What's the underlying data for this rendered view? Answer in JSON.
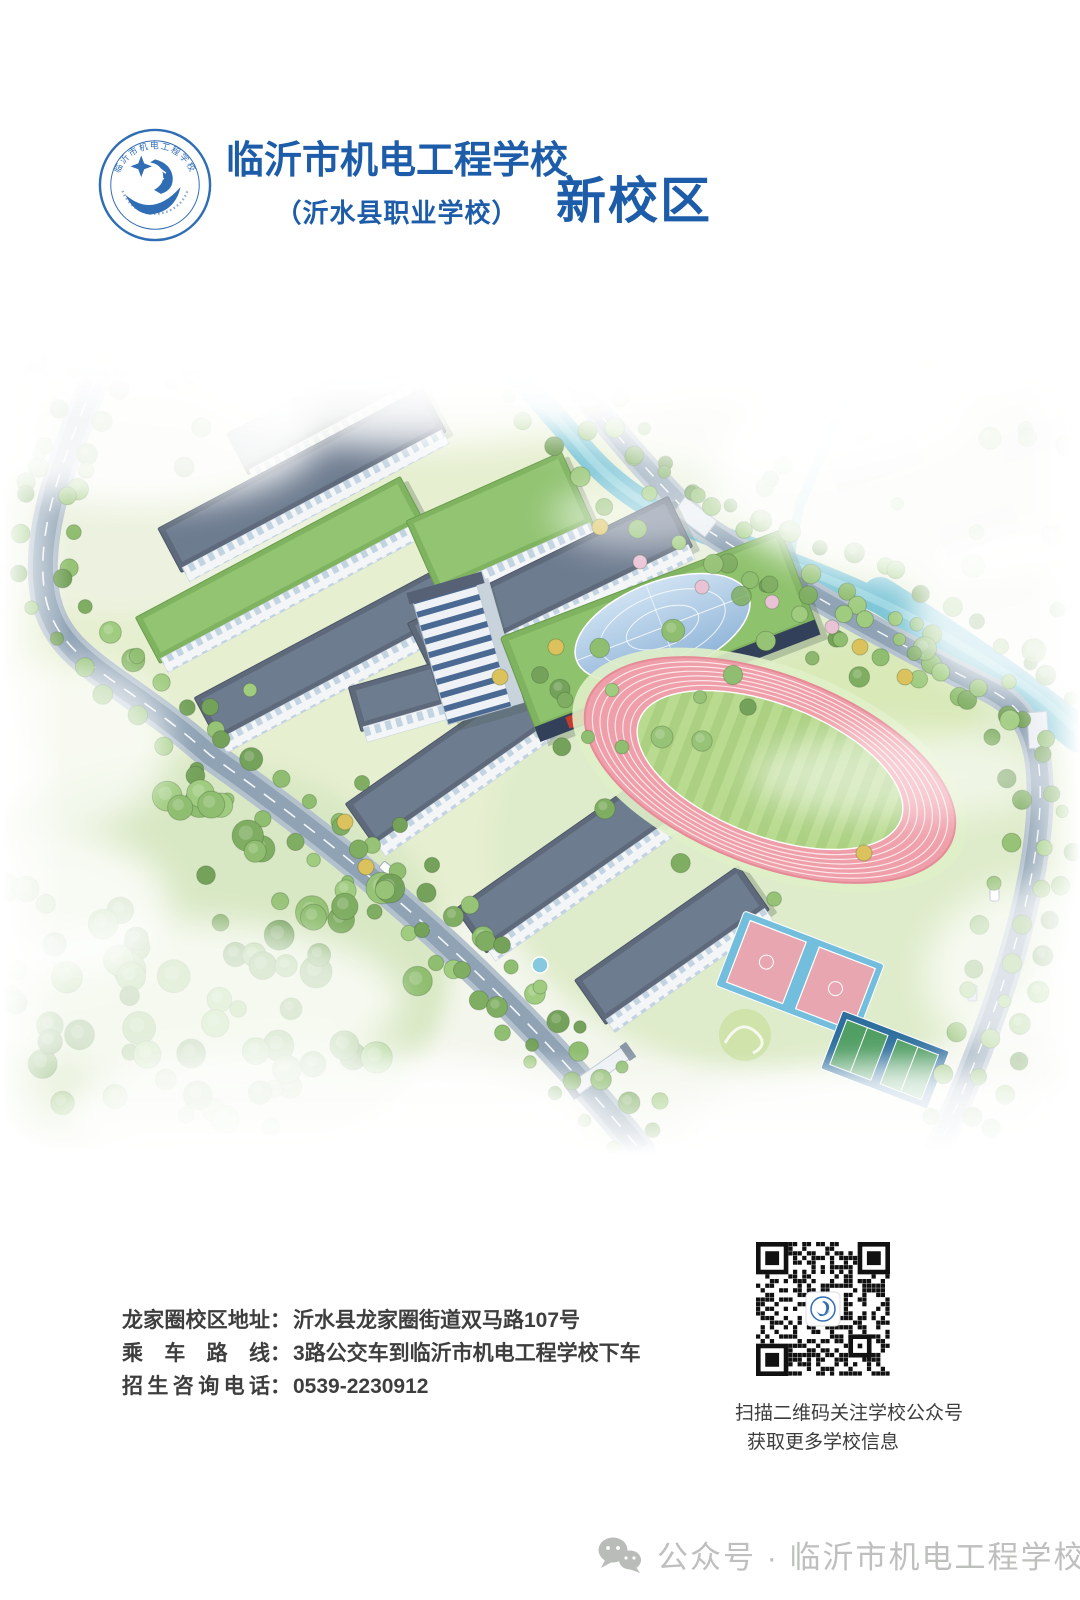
{
  "header": {
    "school_name": "临沂市机电工程学校",
    "school_subtitle": "（沂水县职业学校）",
    "campus_label": "新校区",
    "brand_color": "#1d5ca8",
    "logo": {
      "icon": "school-emblem",
      "ring_text": "临沂市机电工程学校"
    }
  },
  "campus_art": {
    "icon": "campus-aerial-view"
  },
  "contact": {
    "separator": "：",
    "lines": [
      {
        "label": "龙家圈校区地址",
        "value": "沂水县龙家圈街道双马路107号"
      },
      {
        "label": "乘车路线",
        "value": "3路公交车到临沂市机电工程学校下车"
      },
      {
        "label": "招生咨询电话",
        "value": "0539-2230912"
      }
    ]
  },
  "qr_section": {
    "icon": "qr-code",
    "caption_line1": "扫描二维码关注学校公众号",
    "caption_line2": "获取更多学校信息"
  },
  "footer": {
    "wechat_icon": "wechat-chat-bubbles",
    "watermark_text": "公众号 · 临沂市机电工程学校"
  }
}
